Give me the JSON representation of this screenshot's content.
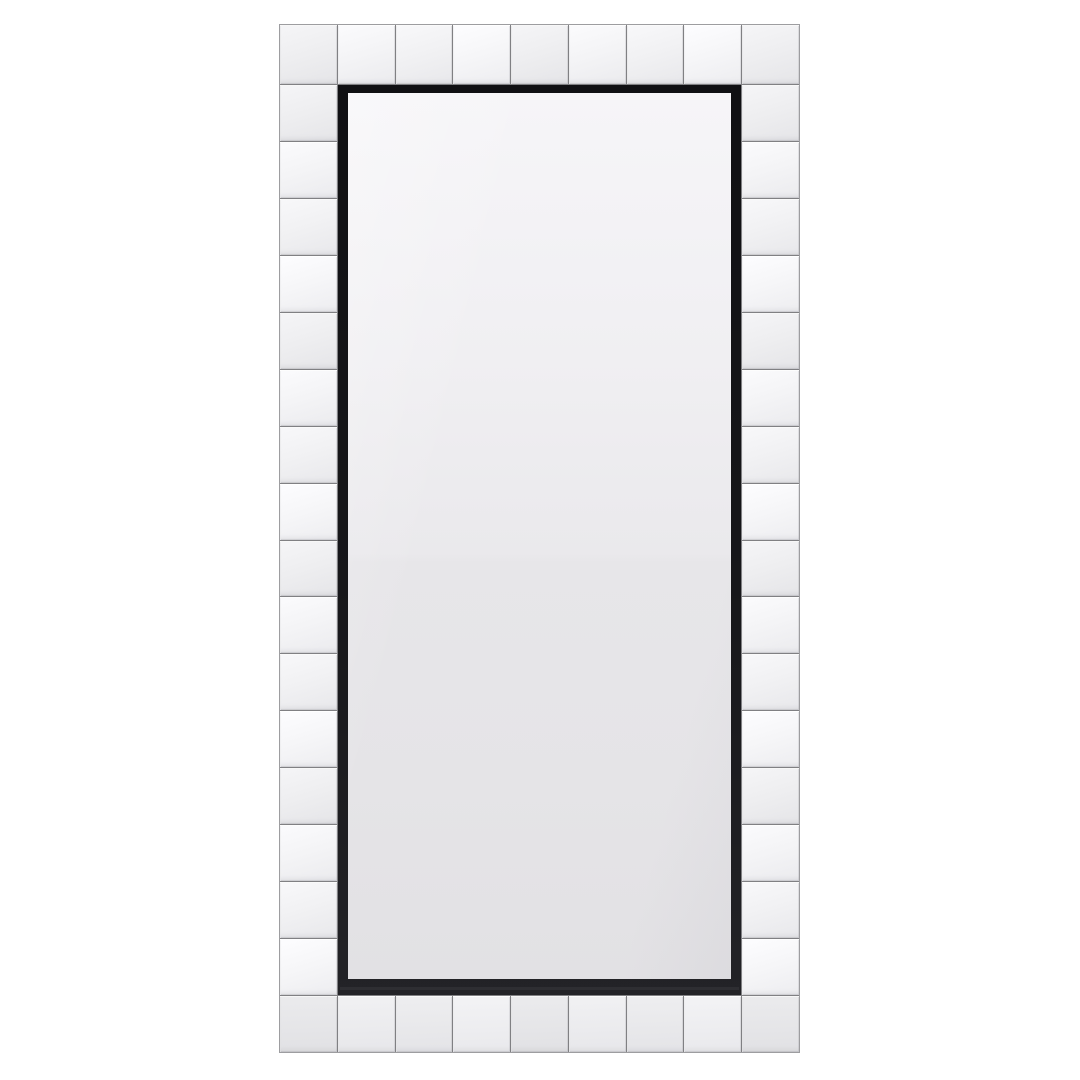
{
  "scene": {
    "type": "product photo",
    "subject": "Full-length rectangular leaner wall mirror with a frame of bevelled square mirror tiles and a black inner trim, on a plain white background",
    "background_color": "#ffffff"
  },
  "mirror": {
    "tile_counts": {
      "top": 9,
      "bottom": 9,
      "left": 16,
      "right": 16
    },
    "colors": {
      "grout": "#808083",
      "outer_edge": "#9d9da0",
      "tile": "#f4f4f6",
      "tile_highlight": "#fbfbfd",
      "tile_shadow": "#ebebee",
      "tile_bottom": "#e8e8eb",
      "inner_frame": "#17171a",
      "glass_top": "#f6f5f8",
      "glass_mid": "#eae9ec",
      "glass_bottom": "#e2e1e4",
      "background_color": "#ffffff"
    }
  }
}
